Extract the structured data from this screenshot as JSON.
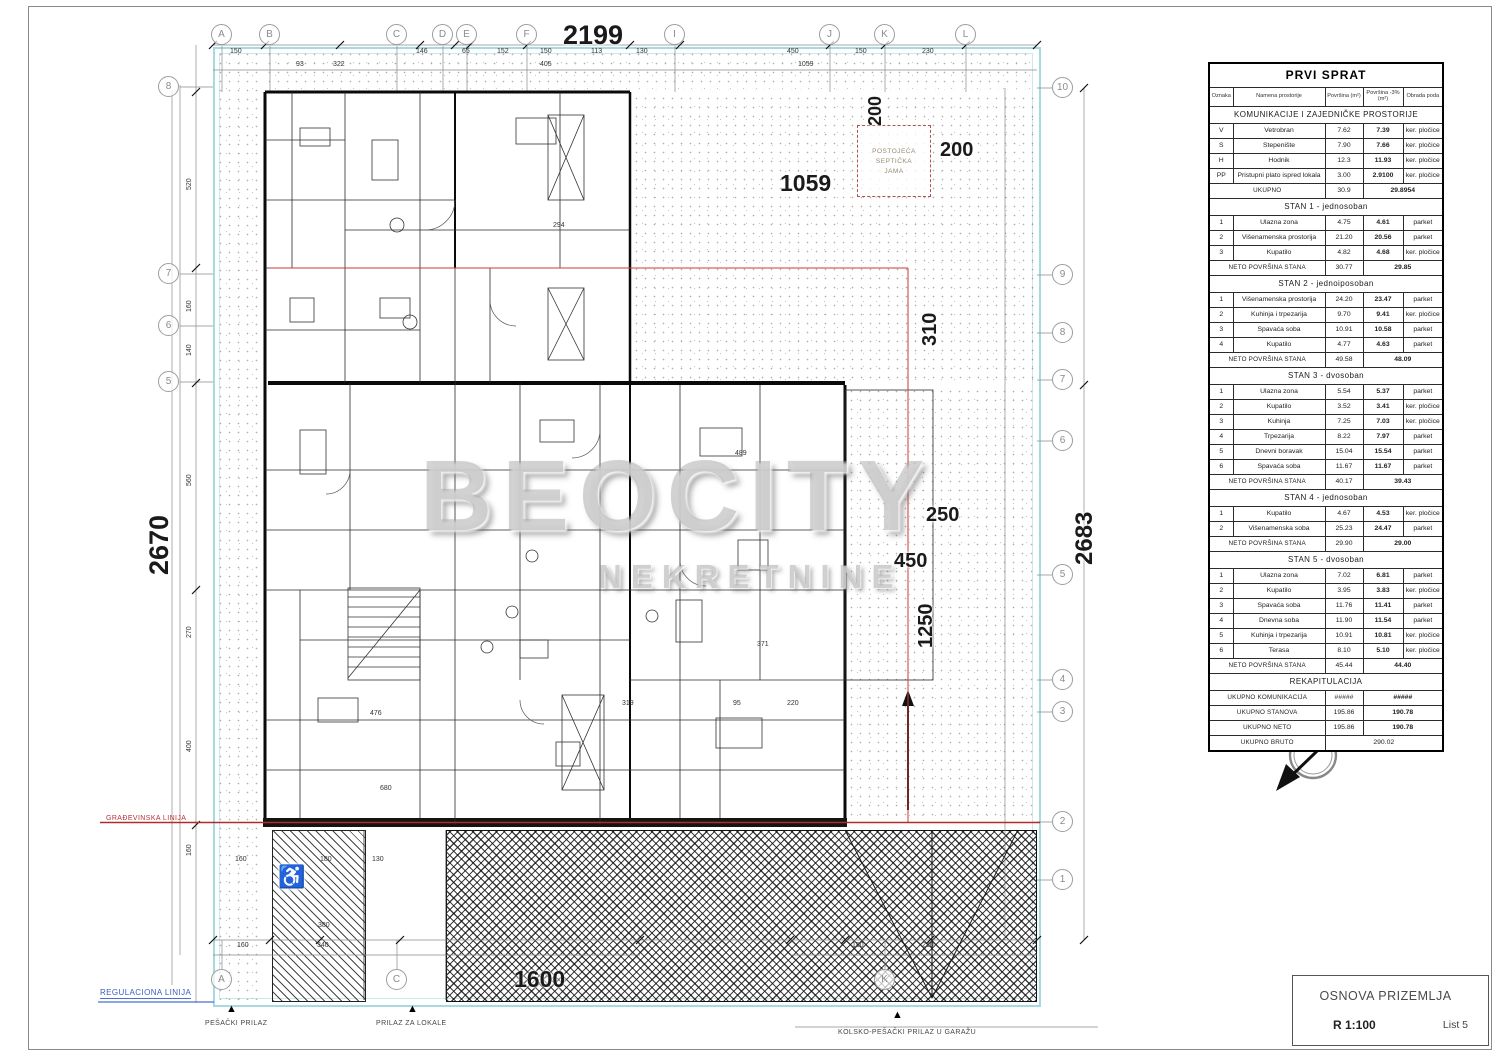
{
  "watermark": {
    "brand": "BEOCITY",
    "sub": "NEKRETNINE"
  },
  "titleblock": {
    "title": "OSNOVA PRIZEMLJA",
    "scale": "R 1:100",
    "sheet": "List 5"
  },
  "site": {
    "regulation_line": "REGULACIONA LINIJA",
    "building_line": "GRAĐEVINSKA LINIJA",
    "septic_line1": "POSTOJEĆA",
    "septic_line2": "SEPTIČKA",
    "septic_line3": "JAMA",
    "north": "S"
  },
  "access": {
    "pedestrian": "PEŠAČKI PRILAZ",
    "shops": "PRILAZ ZA LOKALE",
    "garage": "KOLSKO-PEŠAČKI PRILAZ U GARAŽU"
  },
  "icons": {
    "wheelchair": "♿",
    "marker": "▲"
  },
  "dims": {
    "top": "2199",
    "left": "2670",
    "right": "2683",
    "yard": "1059",
    "v200": "200",
    "h200": "200",
    "v310": "310",
    "h250": "250",
    "h450": "450",
    "v1250": "1250",
    "bottom1600": "1600",
    "small_top": [
      "150",
      "146",
      "65",
      "152",
      "150",
      "113",
      "130",
      "450",
      "150",
      "230",
      "93",
      "322",
      "405",
      "1059"
    ],
    "small_left": [
      "520",
      "160",
      "140",
      "560",
      "270",
      "400",
      "160"
    ],
    "small_bottom": [
      "160",
      "180",
      "130",
      "380",
      "160",
      "340",
      "150",
      "230"
    ],
    "inner": [
      "294",
      "489",
      "371",
      "476",
      "319",
      "680",
      "220",
      "95"
    ]
  },
  "grid": {
    "top": [
      "A",
      "B",
      "C",
      "D",
      "E",
      "F",
      "I",
      "J",
      "K",
      "L"
    ],
    "right": [
      "10",
      "9",
      "8",
      "7",
      "6",
      "5",
      "4",
      "3",
      "2",
      "1"
    ],
    "left": [
      "8",
      "7",
      "6",
      "5"
    ],
    "bottom": [
      "A",
      "C",
      "K"
    ]
  },
  "table": {
    "title": "PRVI SPRAT",
    "headers": [
      "Oznaka",
      "Namena prostorije",
      "Površina (m²)",
      "Površina -3% (m²)",
      "Obrada poda"
    ],
    "rows": [
      {
        "t": "sec",
        "label": "KOMUNIKACIJE I ZAJEDNIČKE PROSTORIJE"
      },
      {
        "t": "d",
        "c": [
          "V",
          "Vetrobran",
          "7.62",
          "7.39",
          "ker. pločice"
        ]
      },
      {
        "t": "d",
        "c": [
          "S",
          "Stepenište",
          "7.90",
          "7.66",
          "ker. pločice"
        ]
      },
      {
        "t": "d",
        "c": [
          "H",
          "Hodnik",
          "12.3",
          "11.93",
          "ker. pločice"
        ]
      },
      {
        "t": "d",
        "c": [
          "PP",
          "Pristupni plato ispred lokala",
          "3.00",
          "2.9100",
          "ker. pločice"
        ]
      },
      {
        "t": "tot",
        "label": "UKUPNO",
        "v1": "30.9",
        "v2": "29.8954"
      },
      {
        "t": "sec",
        "label": "STAN 1 - jednosoban"
      },
      {
        "t": "d",
        "c": [
          "1",
          "Ulazna zona",
          "4.75",
          "4.61",
          "parket"
        ]
      },
      {
        "t": "d",
        "c": [
          "2",
          "Višenamenska prostorija",
          "21.20",
          "20.56",
          "parket"
        ]
      },
      {
        "t": "d",
        "c": [
          "3",
          "Kupatilo",
          "4.82",
          "4.68",
          "ker. pločice"
        ]
      },
      {
        "t": "tot",
        "label": "NETO POVRŠINA STANA",
        "v1": "30.77",
        "v2": "29.85"
      },
      {
        "t": "sec",
        "label": "STAN 2 - jednoiposoban"
      },
      {
        "t": "d",
        "c": [
          "1",
          "Višenamenska prostorija",
          "24.20",
          "23.47",
          "parket"
        ]
      },
      {
        "t": "d",
        "c": [
          "2",
          "Kuhinja i trpezarija",
          "9.70",
          "9.41",
          "ker. pločice"
        ]
      },
      {
        "t": "d",
        "c": [
          "3",
          "Spavaća soba",
          "10.91",
          "10.58",
          "parket"
        ]
      },
      {
        "t": "d",
        "c": [
          "4",
          "Kupatilo",
          "4.77",
          "4.63",
          "parket"
        ]
      },
      {
        "t": "tot",
        "label": "NETO POVRŠINA STANA",
        "v1": "49.58",
        "v2": "48.09"
      },
      {
        "t": "sec",
        "label": "STAN 3 - dvosoban"
      },
      {
        "t": "d",
        "c": [
          "1",
          "Ulazna zona",
          "5.54",
          "5.37",
          "parket"
        ]
      },
      {
        "t": "d",
        "c": [
          "2",
          "Kupatilo",
          "3.52",
          "3.41",
          "ker. pločice"
        ]
      },
      {
        "t": "d",
        "c": [
          "3",
          "Kuhinja",
          "7.25",
          "7.03",
          "ker. pločice"
        ]
      },
      {
        "t": "d",
        "c": [
          "4",
          "Trpezarija",
          "8.22",
          "7.97",
          "parket"
        ]
      },
      {
        "t": "d",
        "c": [
          "5",
          "Dnevni boravak",
          "15.04",
          "15.54",
          "parket"
        ]
      },
      {
        "t": "d",
        "c": [
          "6",
          "Spavaća soba",
          "11.67",
          "11.67",
          "parket"
        ]
      },
      {
        "t": "tot",
        "label": "NETO POVRŠINA STANA",
        "v1": "40.17",
        "v2": "39.43"
      },
      {
        "t": "sec",
        "label": "STAN 4 - jednosoban"
      },
      {
        "t": "d",
        "c": [
          "1",
          "Kupatilo",
          "4.67",
          "4.53",
          "ker. pločice"
        ]
      },
      {
        "t": "d",
        "c": [
          "2",
          "Višenamenska soba",
          "25.23",
          "24.47",
          "parket"
        ]
      },
      {
        "t": "tot",
        "label": "NETO POVRŠINA STANA",
        "v1": "29.90",
        "v2": "29.00"
      },
      {
        "t": "sec",
        "label": "STAN 5 - dvosoban"
      },
      {
        "t": "d",
        "c": [
          "1",
          "Ulazna zona",
          "7.02",
          "6.81",
          "parket"
        ]
      },
      {
        "t": "d",
        "c": [
          "2",
          "Kupatilo",
          "3.95",
          "3.83",
          "ker. pločice"
        ]
      },
      {
        "t": "d",
        "c": [
          "3",
          "Spavaća soba",
          "11.76",
          "11.41",
          "parket"
        ]
      },
      {
        "t": "d",
        "c": [
          "4",
          "Dnevna soba",
          "11.90",
          "11.54",
          "parket"
        ]
      },
      {
        "t": "d",
        "c": [
          "5",
          "Kuhinja i trpezarija",
          "10.91",
          "10.81",
          "ker. pločice"
        ]
      },
      {
        "t": "d",
        "c": [
          "6",
          "Terasa",
          "8.10",
          "5.10",
          "ker. pločice"
        ]
      },
      {
        "t": "tot",
        "label": "NETO POVRŠINA STANA",
        "v1": "45.44",
        "v2": "44.40"
      },
      {
        "t": "sec",
        "label": "REKAPITULACIJA"
      },
      {
        "t": "tot",
        "label": "UKUPNO KOMUNIKACIJA",
        "v1": "#####",
        "v2": "#####"
      },
      {
        "t": "tot",
        "label": "UKUPNO STANOVA",
        "v1": "195.86",
        "v2": "190.78"
      },
      {
        "t": "tot",
        "label": "UKUPNO NETO",
        "v1": "195.86",
        "v2": "190.78"
      },
      {
        "t": "wide",
        "label": "UKUPNO BRUTO",
        "v": "290.02"
      }
    ]
  }
}
